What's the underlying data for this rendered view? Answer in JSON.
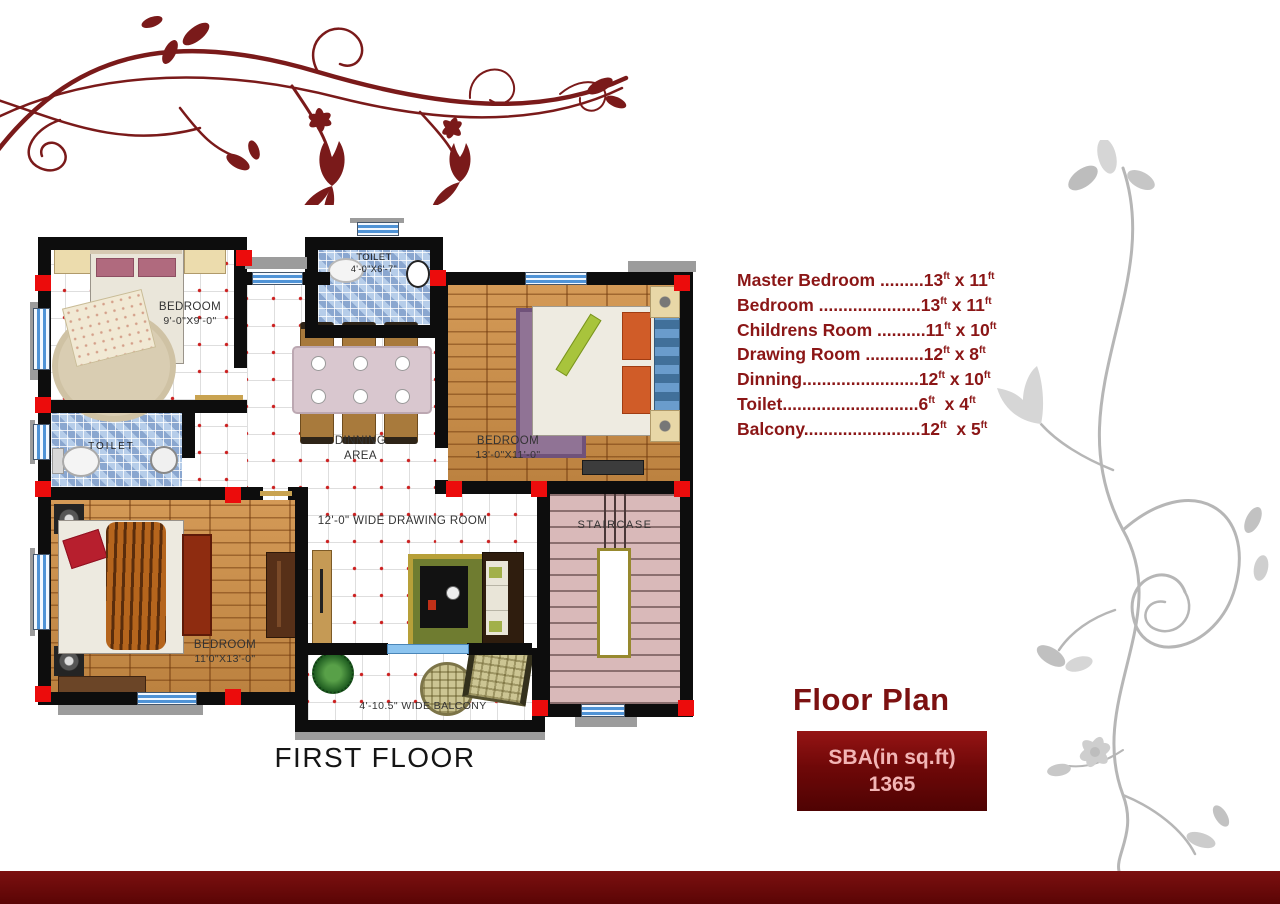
{
  "colors": {
    "accent_maroon": "#8b1616",
    "title_maroon": "#7c1111",
    "footer_maroon": "#6b0808",
    "sba_text_pink": "#f2b5b5",
    "wall_black": "#0d0d0d",
    "corner_red": "#ec0c0c",
    "window_blue": "#4f93d6"
  },
  "plan": {
    "caption": "FIRST FLOOR",
    "labels": {
      "bedroom_tl_name": "BEDROOM",
      "bedroom_tl_dims": "9'-0\"X9'-0\"",
      "toilet_top_name": "TOILET",
      "toilet_top_dims": "4'-0\"X6'-7\"",
      "bedroom_tr_name": "BEDROOM",
      "bedroom_tr_dims": "13'-0\"X11'-0\"",
      "toilet_left_name": "TOILET",
      "dinning_line1": "DINNING",
      "dinning_line2": "AREA",
      "drawing_room": "12'-0\" WIDE DRAWING ROOM",
      "bedroom_bl_name": "BEDROOM",
      "bedroom_bl_dims": "11'0\"X13'-0\"",
      "staircase": "STAIRCASE",
      "balcony": "4'-10.5\" WIDE BALCONY"
    }
  },
  "legend": {
    "unit": "ft",
    "items": [
      {
        "label": "Master Bedroom .........",
        "w": "13",
        "sep": " x ",
        "h": "11"
      },
      {
        "label": "Bedroom .....................",
        "w": "13",
        "sep": " x ",
        "h": "11"
      },
      {
        "label": "Childrens Room ..........",
        "w": "11",
        "sep": " x ",
        "h": "10"
      },
      {
        "label": "Drawing Room ............",
        "w": "12",
        "sep": " x ",
        "h": "8"
      },
      {
        "label": "Dinning........................",
        "w": "12",
        "sep": " x ",
        "h": "10"
      },
      {
        "label": "Toilet............................",
        "w": "6",
        "sep": "  x ",
        "h": "4"
      },
      {
        "label": "Balcony........................",
        "w": "12",
        "sep": "  x ",
        "h": "5"
      }
    ]
  },
  "summary": {
    "title": "Floor Plan",
    "sba_label": "SBA(in sq.ft)",
    "sba_value": "1365"
  }
}
